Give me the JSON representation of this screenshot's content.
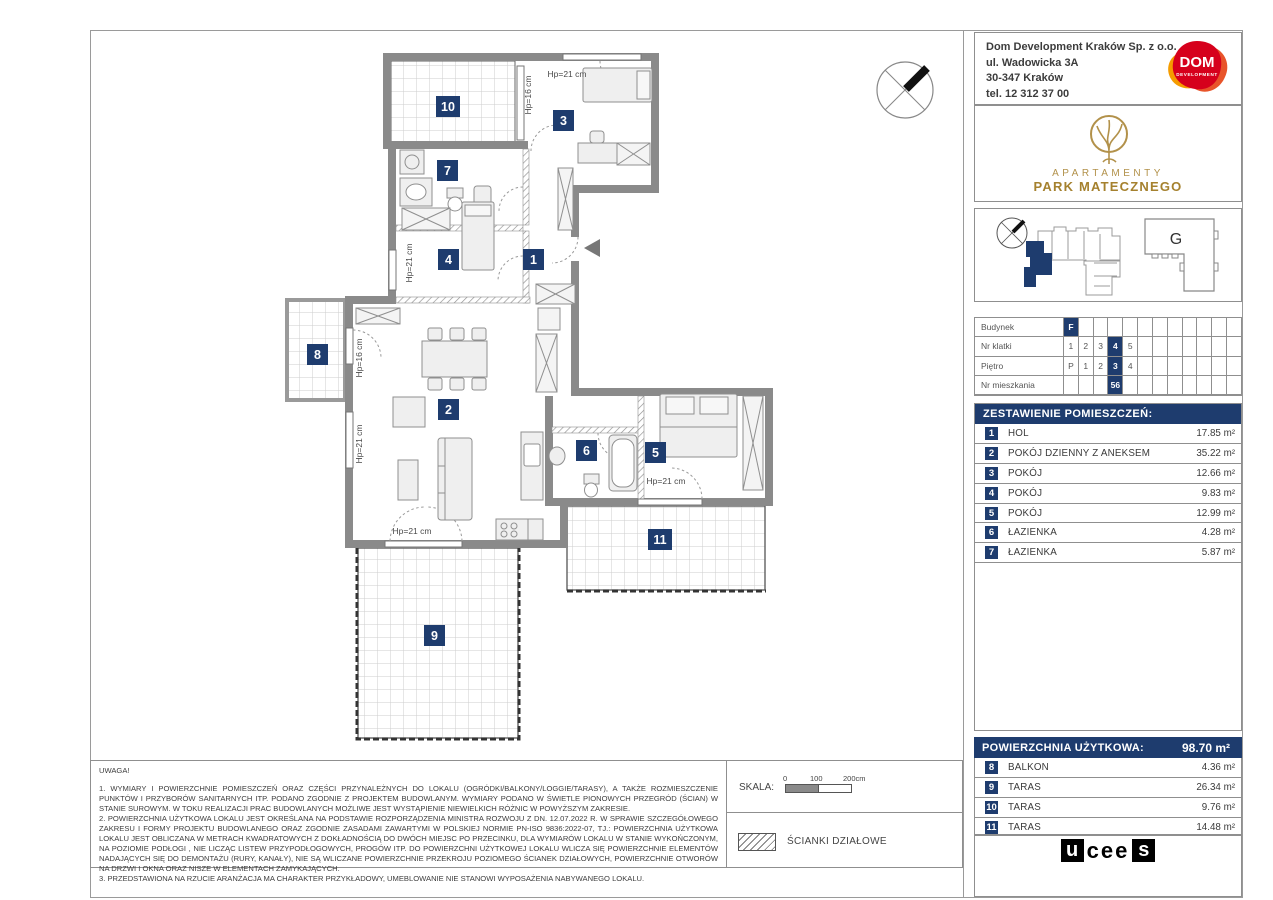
{
  "company": {
    "name": "Dom Development Kraków Sp. z o.o.",
    "address": "ul. Wadowicka 3A",
    "city": "30-347 Kraków",
    "phone": "tel. 12 312 37 00",
    "logo_top": "DOM",
    "logo_bottom": "DEVELOPMENT"
  },
  "branding": {
    "line1": "APARTAMENTY",
    "line2": "PARK MATECZNEGO"
  },
  "site": {
    "building_label": "G"
  },
  "unit_table": {
    "rows": [
      {
        "label": "Budynek",
        "cells": [
          "F",
          "",
          "",
          "",
          "",
          "",
          "",
          "",
          "",
          "",
          "",
          ""
        ],
        "hl": [
          0
        ]
      },
      {
        "label": "Nr klatki",
        "cells": [
          "1",
          "2",
          "3",
          "4",
          "5",
          "",
          "",
          "",
          "",
          "",
          "",
          ""
        ],
        "hl": [
          3
        ]
      },
      {
        "label": "Piętro",
        "cells": [
          "P",
          "1",
          "2",
          "3",
          "4",
          "",
          "",
          "",
          "",
          "",
          "",
          ""
        ],
        "hl": [
          3
        ]
      },
      {
        "label": "Nr mieszkania",
        "cells": [
          "",
          "",
          "",
          "56",
          "",
          "",
          "",
          "",
          "",
          "",
          "",
          ""
        ],
        "hl": [
          3
        ]
      }
    ]
  },
  "rooms": {
    "header": "ZESTAWIENIE POMIESZCZEŃ:",
    "items": [
      {
        "n": "1",
        "label": "HOL",
        "area": "17.85 m²"
      },
      {
        "n": "2",
        "label": "POKÓJ DZIENNY Z ANEKSEM",
        "area": "35.22 m²"
      },
      {
        "n": "3",
        "label": "POKÓJ",
        "area": "12.66 m²"
      },
      {
        "n": "4",
        "label": "POKÓJ",
        "area": "9.83 m²"
      },
      {
        "n": "5",
        "label": "POKÓJ",
        "area": "12.99 m²"
      },
      {
        "n": "6",
        "label": "ŁAZIENKA",
        "area": "4.28 m²"
      },
      {
        "n": "7",
        "label": "ŁAZIENKA",
        "area": "5.87 m²"
      }
    ]
  },
  "usable_area": {
    "label": "POWIERZCHNIA UŻYTKOWA:",
    "value": "98.70 m²"
  },
  "outdoor": [
    {
      "n": "8",
      "label": "BALKON",
      "area": "4.36 m²"
    },
    {
      "n": "9",
      "label": "TARAS",
      "area": "26.34 m²"
    },
    {
      "n": "10",
      "label": "TARAS",
      "area": "9.76 m²"
    },
    {
      "n": "11",
      "label": "TARAS",
      "area": "14.48 m²"
    }
  ],
  "footer_logo": {
    "l1": "u",
    "l2": "cee",
    "l3": "s"
  },
  "plan": {
    "badges": {
      "b1": "1",
      "b2": "2",
      "b3": "3",
      "b4": "4",
      "b5": "5",
      "b6": "6",
      "b7": "7",
      "b8": "8",
      "b9": "9",
      "b10": "10",
      "b11": "11"
    },
    "hp": {
      "t1": "Hp=21 cm",
      "t2": "Hp=16 cm",
      "t3": "Hp=21 cm",
      "t4": "Hp=16 cm",
      "t5": "Hp=21 cm",
      "t6": "Hp=21 cm",
      "t7": "Hp=21 cm"
    }
  },
  "notes": {
    "title": "UWAGA!",
    "p1": "1. WYMIARY I POWIERZCHNIE POMIESZCZEŃ ORAZ CZĘŚCI PRZYNALEŻNYCH DO LOKALU (OGRÓDKI/BALKONY/LOGGIE/TARASY), A TAKŻE ROZMIESZCZENIE PUNKTÓW I PRZYBORÓW SANITARNYCH ITP. PODANO ZGODNIE Z PROJEKTEM BUDOWLANYM. WYMIARY PODANO W ŚWIETLE PIONOWYCH PRZEGRÓD (ŚCIAN) W STANIE SUROWYM. W TOKU REALIZACJI PRAC BUDOWLANYCH MOŻLIWE JEST WYSTĄPIENIE NIEWIELKICH RÓŻNIC W POWYŻSZYM ZAKRESIE.",
    "p2": "2. POWIERZCHNIA UŻYTKOWA LOKALU JEST OKREŚLANA NA PODSTAWIE ROZPORZĄDZENIA MINISTRA ROZWOJU Z DN. 12.07.2022 R. W SPRAWIE SZCZEGÓŁOWEGO ZAKRESU I FORMY PROJEKTU BUDOWLANEGO ORAZ ZGODNIE ZASADAMI ZAWARTYMI W POLSKIEJ NORMIE PN-ISO 9836:2022-07, TJ.: POWIERZCHNIA UŻYTKOWA LOKALU JEST OBLICZANA W METRACH KWADRATOWYCH Z DOKŁADNOŚCIĄ DO DWÓCH MIEJSC PO PRZECINKU, DLA WYMIARÓW LOKALU W STANIE WYKOŃCZONYM, NA POZIOMIE PODŁOGI , NIE LICZĄC LISTEW PRZYPODŁOGOWYCH, PROGÓW ITP. DO POWIERZCHNI UŻYTKOWEJ LOKALU WLICZA SIĘ POWIERZCHNIE ELEMENTÓW NADAJĄCYCH SIĘ DO DEMONTAŻU (RURY, KANAŁY), NIE SĄ WLICZANE POWIERZCHNIE PRZEKROJU POZIOMEGO ŚCIANEK DZIAŁOWYCH, POWIERZCHNIE OTWORÓW NA DRZWI I OKNA ORAZ NISZE W ELEMENTACH ZAMYKAJĄCYCH.",
    "p3": "3. PRZEDSTAWIONA NA RZUCIE ARANŻACJA MA CHARAKTER PRZYKŁADOWY, UMEBLOWANIE NIE STANOWI WYPOSAŻENIA NABYWANEGO LOKALU."
  },
  "scale": {
    "label": "SKALA:",
    "t0": "0",
    "t100": "100",
    "t200": "200cm"
  },
  "legend": {
    "partitions": "ŚCIANKI DZIAŁOWE"
  },
  "colors": {
    "navy": "#1e3c6e",
    "wall": "#8a8a8a",
    "logo_red": "#d6001c",
    "logo_orange": "#f59c00",
    "gold": "#a5812e"
  }
}
